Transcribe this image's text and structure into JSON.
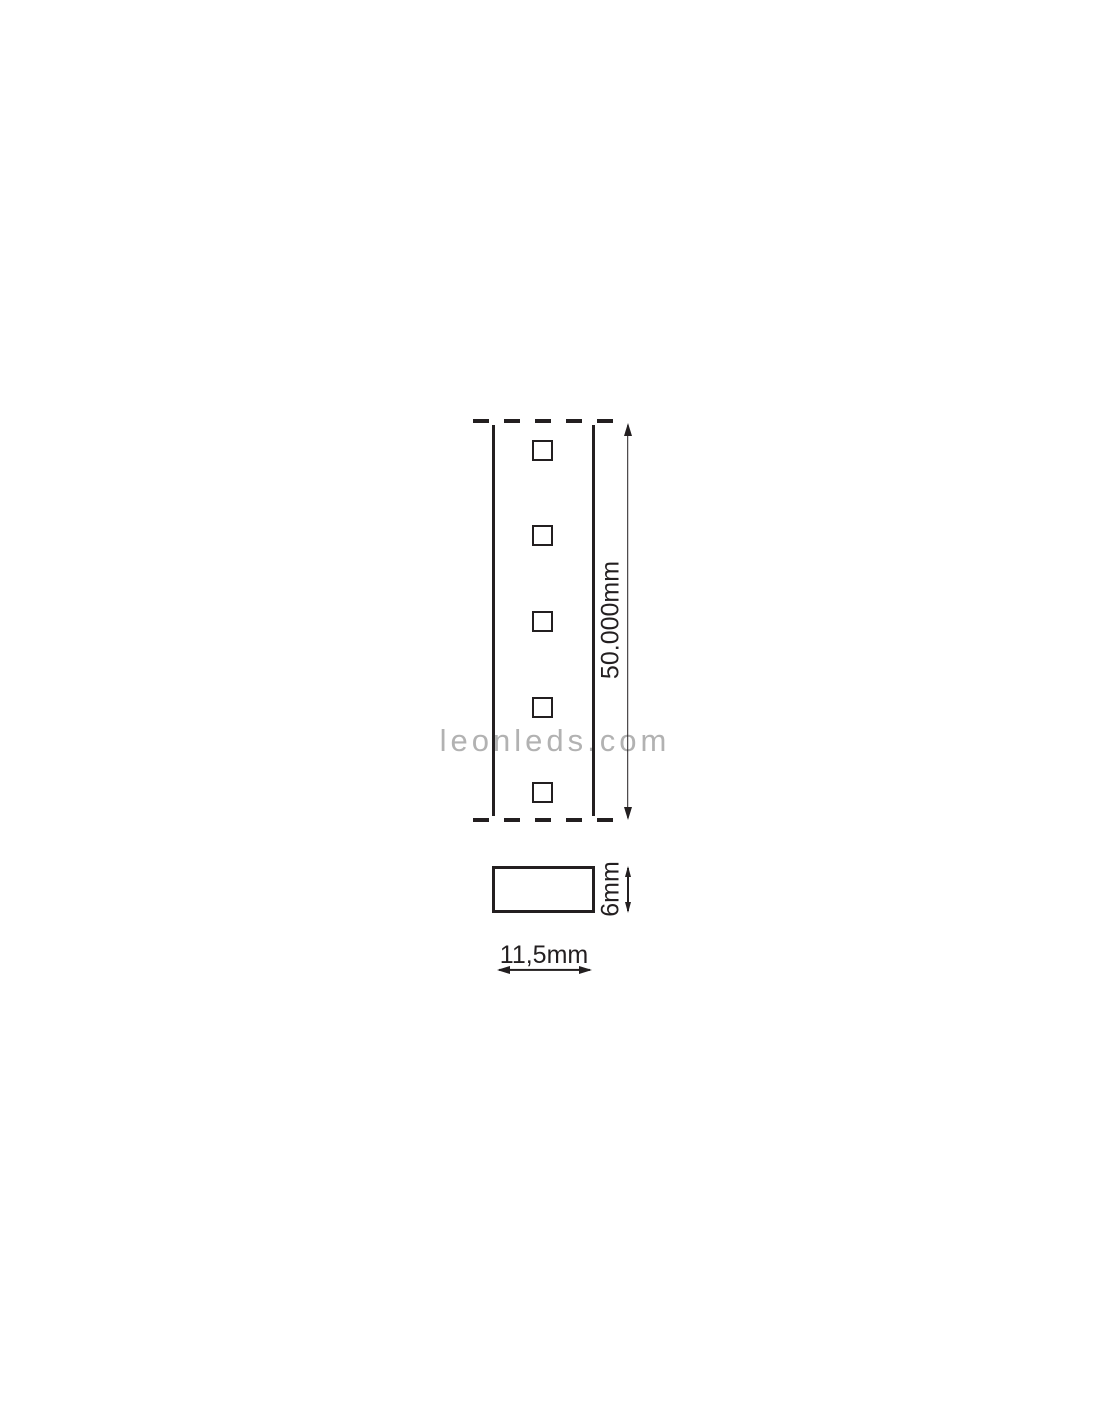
{
  "diagram": {
    "watermark": {
      "text": "leonleds.com",
      "color": "#b2b2b2"
    },
    "colors": {
      "line": "#231f20",
      "background": "#ffffff"
    },
    "strip_top_view": {
      "led_count": 5,
      "edge_style": "dashed ends, solid sides"
    },
    "dimensions": {
      "strip_length_label": "50.000mm",
      "profile_height_label": "6mm",
      "profile_width_label": "11,5mm"
    }
  }
}
